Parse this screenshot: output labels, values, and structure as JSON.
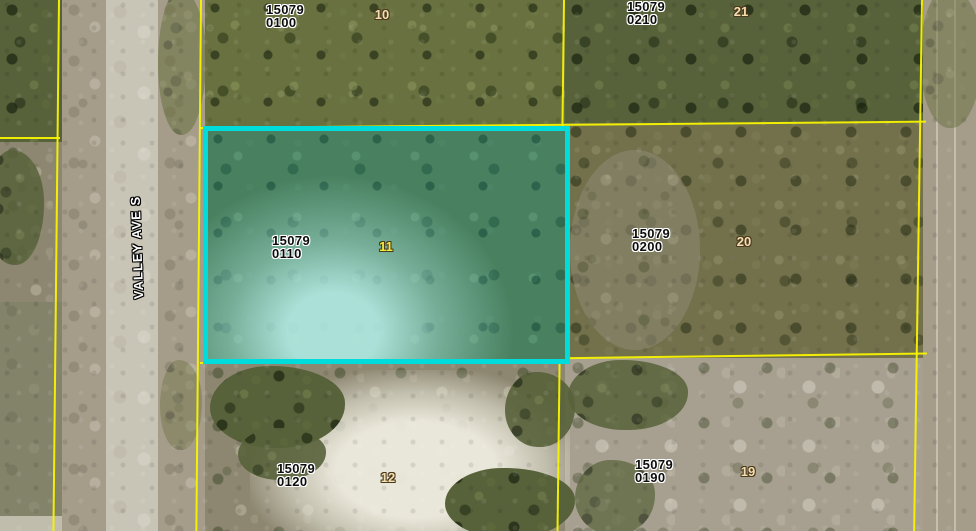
{
  "map": {
    "street": {
      "label": "VALLEY AVE S"
    },
    "parcels": [
      {
        "id_line1": "15079",
        "id_line2": "0100",
        "lot": "10",
        "highlighted": false
      },
      {
        "id_line1": "15079",
        "id_line2": "0210",
        "lot": "21",
        "highlighted": false
      },
      {
        "id_line1": "15079",
        "id_line2": "0110",
        "lot": "11",
        "highlighted": true
      },
      {
        "id_line1": "15079",
        "id_line2": "0200",
        "lot": "20",
        "highlighted": false
      },
      {
        "id_line1": "15079",
        "id_line2": "0120",
        "lot": "12",
        "highlighted": false
      },
      {
        "id_line1": "15079",
        "id_line2": "0190",
        "lot": "19",
        "highlighted": false
      }
    ],
    "colors": {
      "parcel_boundary": "#f8f400",
      "selection_outline": "#00dbdb",
      "lot_number": "#f6dfae",
      "lot_number_selected": "#ecec3e"
    }
  }
}
